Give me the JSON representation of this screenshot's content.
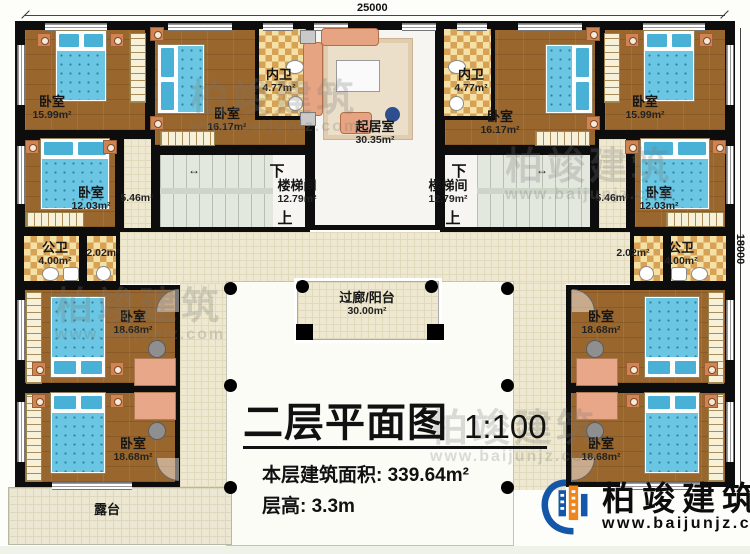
{
  "dimensions": {
    "width_top": "25000",
    "height_right": "18000"
  },
  "rooms": {
    "bedroom_tl": {
      "name": "卧室",
      "area": "15.99m²"
    },
    "bedroom_ml": {
      "name": "卧室",
      "area": "16.17m²"
    },
    "ensuite_l": {
      "name": "内卫",
      "area": "4.77m²"
    },
    "living": {
      "name": "起居室",
      "area": "30.35m²"
    },
    "ensuite_r": {
      "name": "内卫",
      "area": "4.77m²"
    },
    "bedroom_mr": {
      "name": "卧室",
      "area": "16.17m²"
    },
    "bedroom_tr": {
      "name": "卧室",
      "area": "15.99m²"
    },
    "bedroom_l2": {
      "name": "卧室",
      "area": "12.03m²"
    },
    "hall_l": {
      "area": "5.46m²"
    },
    "stair_l": {
      "name": "楼梯间",
      "area": "12.79m²",
      "down": "下",
      "up": "上"
    },
    "stair_r": {
      "name": "楼梯间",
      "area": "12.79m²",
      "down": "下",
      "up": "上"
    },
    "hall_r": {
      "area": "5.46m²"
    },
    "bedroom_r2": {
      "name": "卧室",
      "area": "12.03m²"
    },
    "bath_l": {
      "name": "公卫",
      "area": "4.00m²"
    },
    "lobby_l": {
      "area": "2.02m²"
    },
    "lobby_r": {
      "area": "2.02m²"
    },
    "bath_r": {
      "name": "公卫",
      "area": "4.00m²"
    },
    "bedroom_bl1": {
      "name": "卧室",
      "area": "18.68m²"
    },
    "bedroom_bl2": {
      "name": "卧室",
      "area": "18.68m²"
    },
    "bedroom_br1": {
      "name": "卧室",
      "area": "18.68m²"
    },
    "bedroom_br2": {
      "name": "卧室",
      "area": "18.68m²"
    },
    "balcony": {
      "name": "过廊/阳台",
      "area": "30.00m²"
    },
    "terrace": {
      "name": "露台"
    }
  },
  "title_block": {
    "title": "二层平面图",
    "scale": "1:100",
    "area_label": "本层建筑面积:",
    "area_value": "339.64m²",
    "height_label": "层高:",
    "height_value": "3.3m"
  },
  "branding": {
    "logo_name": "柏竣建筑",
    "logo_url": "www.baijunjz.com"
  },
  "watermark": {
    "text": "柏竣建筑",
    "url": "www.baijunjz.com"
  }
}
